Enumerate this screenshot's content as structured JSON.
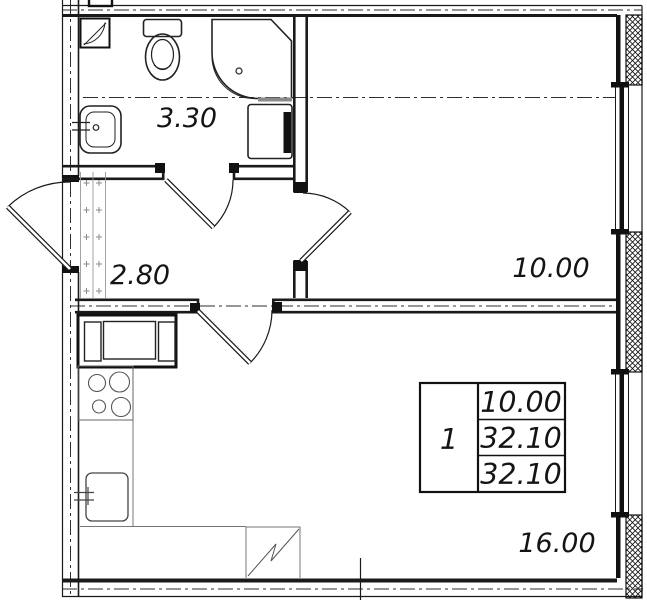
{
  "plan": {
    "labels": {
      "bathroom_area": "3.30",
      "hallway_area": "2.80",
      "room_area": "10.00",
      "kitchen_living_area": "16.00"
    },
    "info_table": {
      "rooms_count": "1",
      "living_area": "10.00",
      "total_area": "32.10",
      "overall_area": "32.10"
    },
    "colors": {
      "line": "#1a1a1a",
      "background": "#ffffff"
    }
  }
}
